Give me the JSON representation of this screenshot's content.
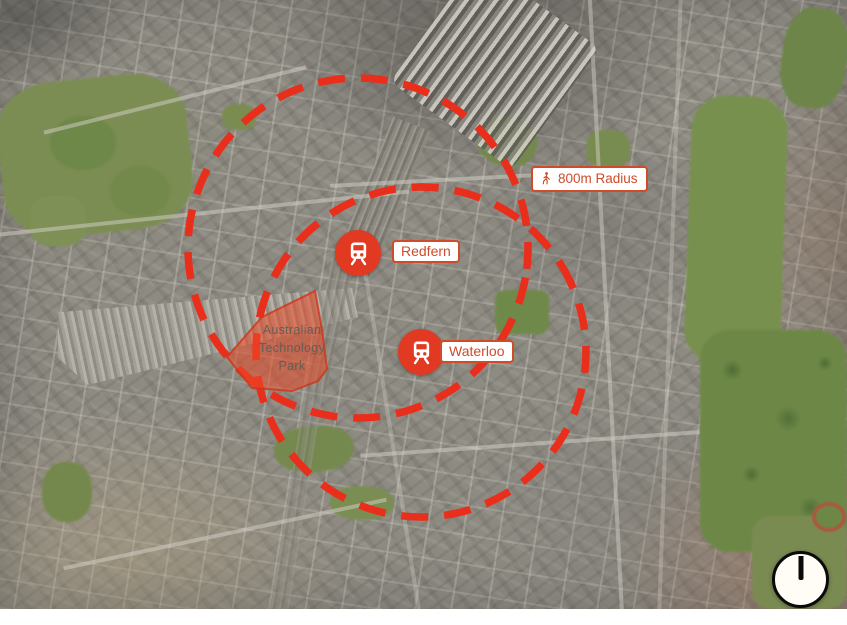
{
  "map": {
    "basemap": "satellite-aerial-photo",
    "radius_badge": {
      "icon": "walking-person-icon",
      "label": "800m Radius"
    },
    "stations": [
      {
        "name": "Redfern",
        "marker": "train-station"
      },
      {
        "name": "Waterloo",
        "marker": "train-station"
      }
    ],
    "area": {
      "label_lines": [
        "Australian",
        "Technology",
        "Park"
      ]
    },
    "compass": {
      "icon": "north-compass"
    },
    "colors": {
      "dash_red": "#e92e1c",
      "label_border": "#cf4b2a",
      "station_marker_red": "#e23a22",
      "area_fill": "rgba(235,75,40,0.55)"
    }
  }
}
